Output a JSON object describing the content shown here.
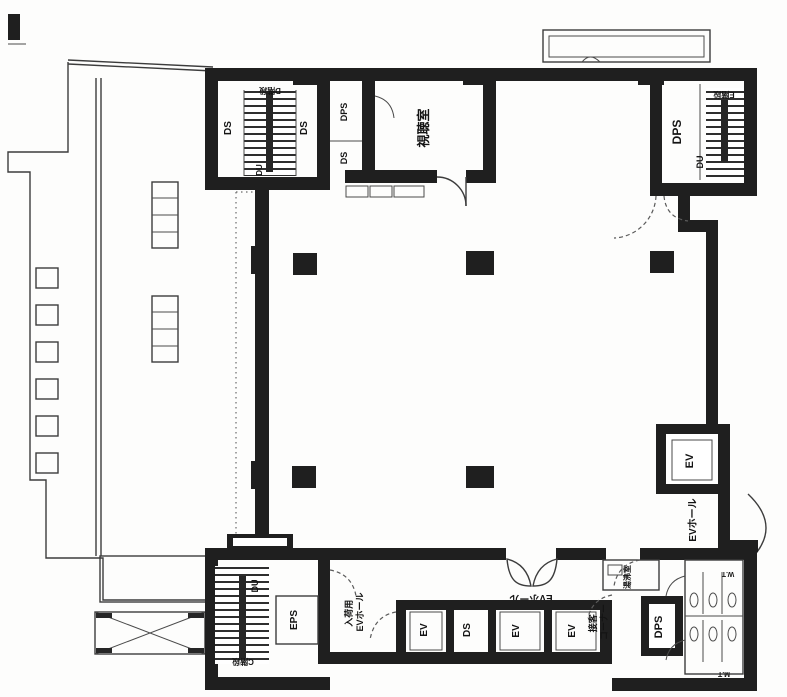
{
  "plan": {
    "type": "architectural-floor-plan",
    "colors": {
      "wall": "#1f1f1f",
      "thin_line": "#3c3c3c",
      "background": "#fdfdfc"
    },
    "shafts": {
      "ds": "DS",
      "dps": "DPS",
      "eps": "EPS",
      "du": "DU",
      "ev": "EV"
    },
    "rooms": {
      "av_room": "視聴室",
      "stair_top_left": "D階段",
      "stair_top_right": "E階段",
      "stair_bottom_left": "C階段",
      "kitchenette": "湯沸室",
      "ev_hall": "EVホール",
      "loading_hall_line1": "入荷用",
      "loading_hall_line2": "EVホール",
      "customer_corner_line1": "接客",
      "customer_corner_line2": "コーナー",
      "womens_toilet": "W.T",
      "mens_toilet": "M.T"
    }
  }
}
